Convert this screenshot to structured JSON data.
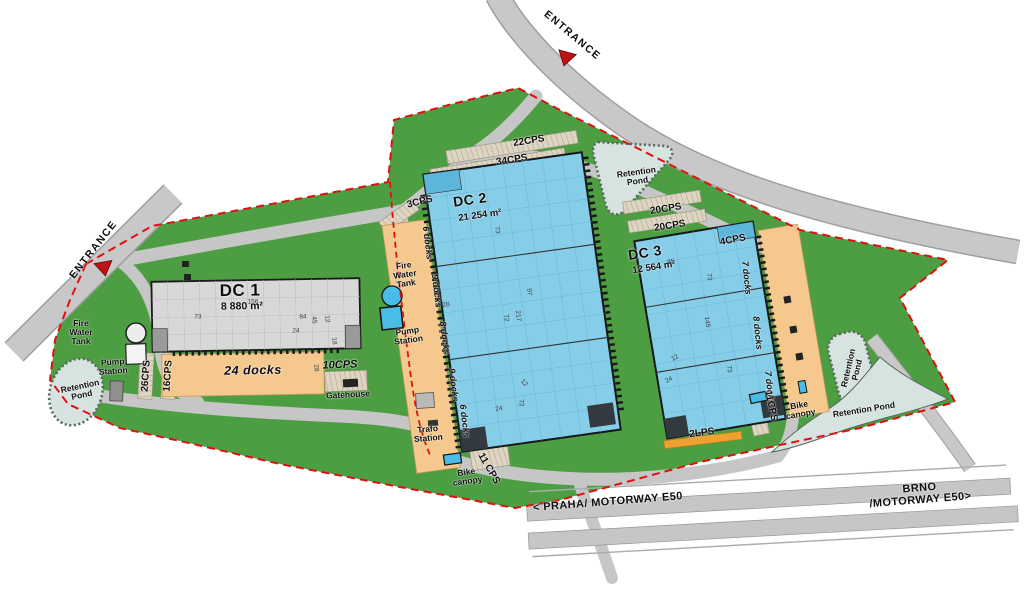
{
  "roads": {
    "entrance_top": "ENTRANCE",
    "entrance_left": "ENTRANCE",
    "motorway_west": "< PRAHA/ MOTORWAY E50",
    "motorway_east": "BRNO /MOTORWAY E50>"
  },
  "buildings": {
    "dc1": {
      "name": "DC 1",
      "area": "8 880 m²",
      "docks_label": "24 docks"
    },
    "dc2": {
      "name": "DC 2",
      "area": "21 254 m²",
      "dock_rows": [
        "6 docks",
        "9 docks",
        "8 docks",
        "9 docks",
        "6 docks"
      ]
    },
    "dc3": {
      "name": "DC 3",
      "area": "12 564 m²",
      "dock_rows": [
        "7 docks",
        "8 docks",
        "7 docks"
      ]
    }
  },
  "parking": {
    "cps22": "22CPS",
    "cps34": "34CPS",
    "cps3": "3CPS",
    "cps20a": "20CPS",
    "cps20b": "20CPS",
    "cps4": "4CPS",
    "cps10": "10CPS",
    "cps26": "26CPS",
    "cps16": "16CPS",
    "cps11a": "11 CPS",
    "cps11b": "11CPS",
    "lps2": "2LPS"
  },
  "facilities": {
    "fire_water_tank": "Fire\nWater\nTank",
    "pump_station": "Pump\nStation",
    "gatehouse": "Gatehouse",
    "trafo_station": "Trafo\nStation",
    "bike_canopy": "Bike\ncanopy",
    "retention_pond": "Retention\nPond",
    "retention_pond_inline": "Retention Pond"
  },
  "dims": {
    "dc1": [
      "156",
      "73",
      "84",
      "24",
      "45",
      "12",
      "18",
      "28"
    ],
    "dc2": [
      "73",
      "28",
      "97",
      "217",
      "72",
      "12",
      "24",
      "72"
    ],
    "dc3": [
      "85",
      "73",
      "145",
      "12",
      "24",
      "73"
    ]
  },
  "colors": {
    "site_green": "#4d9e42",
    "road_gray": "#c8c8c8",
    "building_blue": "#86cde8",
    "building_gray": "#d8d8d8",
    "dock_tan": "#f5c98e",
    "pond_fill": "#d7e3e0",
    "boundary_red": "#e01010",
    "accent_orange": "#f0a030"
  }
}
